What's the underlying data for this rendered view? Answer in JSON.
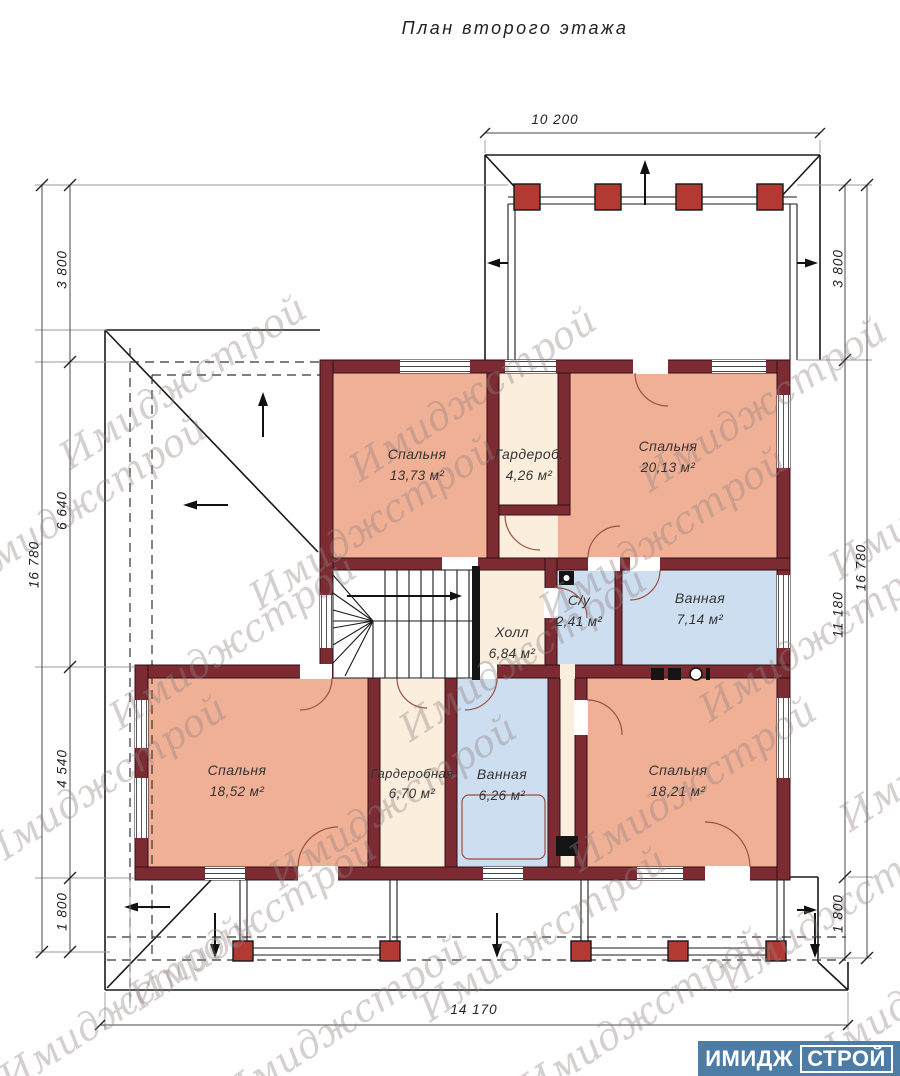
{
  "title": "План второго этажа",
  "watermark": {
    "text": "Имиджстрой"
  },
  "logo": {
    "part1": "ИМИДЖ",
    "part2": "СТРОЙ"
  },
  "rooms": [
    {
      "name": "Спальня",
      "area": "13,73 м²"
    },
    {
      "name": "Гардероб.",
      "area": "4,26 м²"
    },
    {
      "name": "Спальня",
      "area": "20,13 м²"
    },
    {
      "name": "С/у",
      "area": "2,41 м²"
    },
    {
      "name": "Ванная",
      "area": "7,14 м²"
    },
    {
      "name": "Холл",
      "area": "6,84 м²"
    },
    {
      "name": "Спальня",
      "area": "18,52 м²"
    },
    {
      "name": "Гардеробная",
      "area": "6,70 м²"
    },
    {
      "name": "Ванная",
      "area": "6,26 м²"
    },
    {
      "name": "Спальня",
      "area": "18,21 м²"
    }
  ],
  "dimensions": {
    "top": "10 200",
    "bottom": "14 170",
    "left_outer": "16 780",
    "right_outer": "16 780",
    "left_inner": [
      "3 800",
      "6 640",
      "4 540",
      "1 800"
    ],
    "right_inner": [
      "3 800",
      "11 180",
      "1 800"
    ]
  },
  "colors": {
    "wall": "#7d2b33",
    "bedroom_fill": "#f0b096",
    "service_fill": "#fbeedd",
    "wet_fill": "#cddef0",
    "column": "#b23a32",
    "brand_blue": "#4d7ca6"
  }
}
